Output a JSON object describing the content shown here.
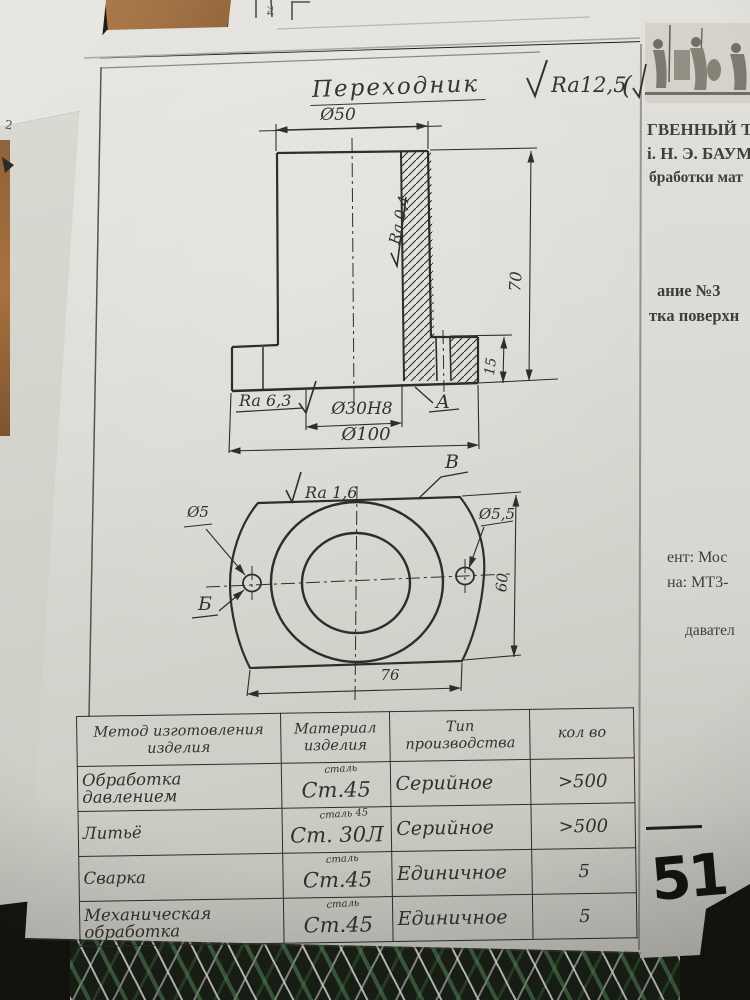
{
  "colors": {
    "paper": "#dcdbd4",
    "ink": "#2e2d2a",
    "wood": "#a9713f",
    "marker": "#151410",
    "fabric_green": "#4c7a50"
  },
  "sheet": {
    "title": "Переходник",
    "roughness_note": "Ra12,5",
    "roughness_paren": "(",
    "edge_mark": "2",
    "top_sheet_dim": "74"
  },
  "section_view": {
    "dia_top": "Ø50",
    "bore_roughness": "Ra 0,4",
    "height": "70",
    "flange_height": "15",
    "base_roughness": "Ra 6,3",
    "bore_dia": "Ø30Н8",
    "surface_label": "А",
    "flange_dia": "Ø100"
  },
  "plan_view": {
    "face_roughness": "Ra 1,6",
    "surface_label_v": "В",
    "hole_dia_left": "Ø5",
    "hole_dia_right": "Ø5,5",
    "height": "60",
    "hole_label": "Б",
    "width": "76"
  },
  "table": {
    "headers": [
      "Метод изготовления изделия",
      "Материал изделия",
      "Тип производства",
      "кол во"
    ],
    "rows": [
      {
        "method": "Обработка давлением",
        "material": "Ст.45",
        "material_note": "сталь",
        "type": "Серийное",
        "qty": ">500"
      },
      {
        "method": "Литьё",
        "material": "Ст. 30Л",
        "material_note": "сталь 45",
        "type": "Серийное",
        "qty": ">500"
      },
      {
        "method": "Сварка",
        "material": "Ст.45",
        "material_note": "сталь",
        "type": "Единичное",
        "qty": "5"
      },
      {
        "method": "Механическая обработка",
        "material": "Ст.45",
        "material_note": "сталь",
        "type": "Единичное",
        "qty": "5"
      }
    ]
  },
  "background": {
    "letterhead": {
      "line1": "ГВЕННЫЙ ТЕ",
      "line2": "і. Н. Э. БАУМ",
      "line3": "бработки мат",
      "assignment1": "ание №3",
      "assignment2": "тка поверхн",
      "student1": "ент: Мос",
      "student2": "на: МТ3-",
      "teacher": "давател"
    },
    "page_number": "51"
  }
}
